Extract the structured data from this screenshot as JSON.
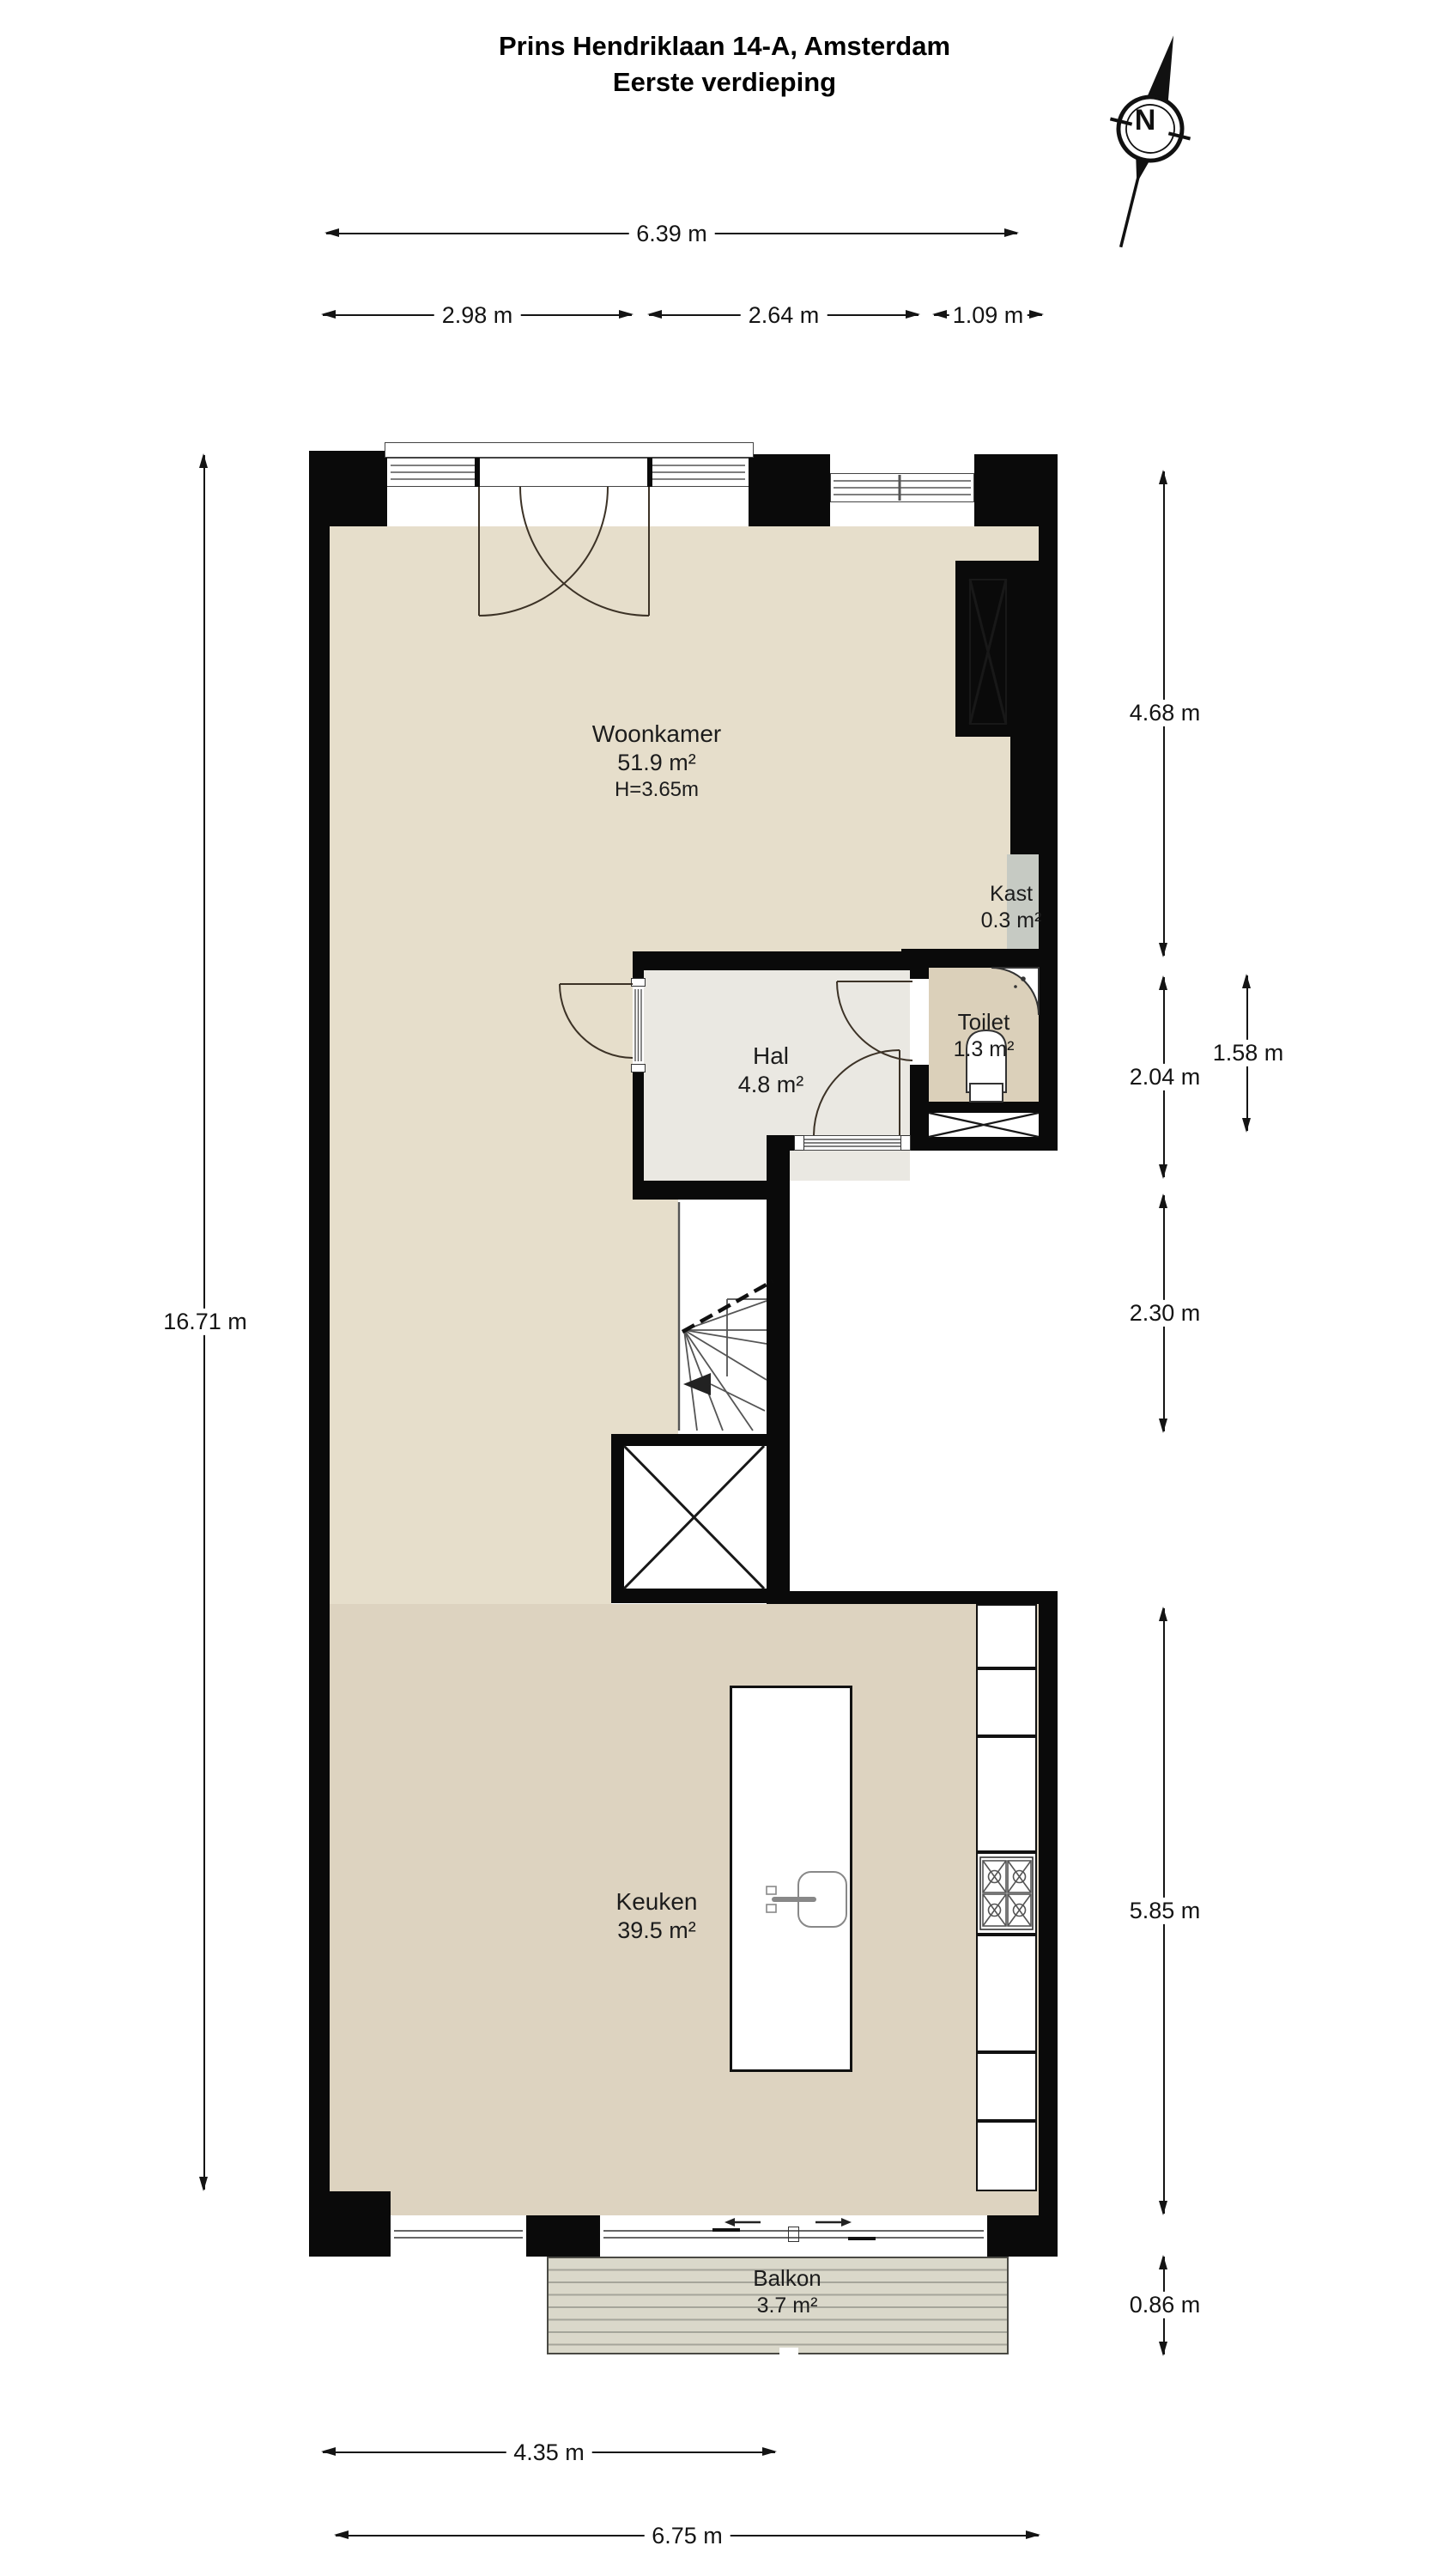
{
  "title": {
    "line1": "Prins Hendriklaan 14-A, Amsterdam",
    "line2": "Eerste verdieping"
  },
  "compass": {
    "label": "N"
  },
  "rooms": {
    "woonkamer": {
      "name": "Woonkamer",
      "area": "51.9 m²",
      "height": "H=3.65m"
    },
    "hal": {
      "name": "Hal",
      "area": "4.8 m²"
    },
    "toilet": {
      "name": "Toilet",
      "area": "1.3 m²"
    },
    "kast": {
      "name": "Kast",
      "area": "0.3 m²"
    },
    "keuken": {
      "name": "Keuken",
      "area": "39.5 m²"
    },
    "balkon": {
      "name": "Balkon",
      "area": "3.7 m²"
    }
  },
  "dimensions": {
    "top_total": "6.39 m",
    "top_left": "2.98 m",
    "top_mid": "2.64 m",
    "top_right": "1.09 m",
    "left_total": "16.71 m",
    "right_livingroom": "4.68 m",
    "right_hal": "2.04 m",
    "right_toilet": "1.58 m",
    "right_stairs": "2.30 m",
    "right_kitchen": "5.85 m",
    "right_balkon": "0.86 m",
    "bottom_inner": "4.35 m",
    "bottom_total": "6.75 m"
  },
  "colors": {
    "wall": "#0a0a0a",
    "floor_living": "#e6decb",
    "floor_kitchen": "#ddd3c0",
    "floor_hal": "#eae8e2",
    "floor_toilet": "#dbd0ba",
    "closet_gray": "#c6cac3",
    "balcony_deck": "#dad8ca"
  }
}
